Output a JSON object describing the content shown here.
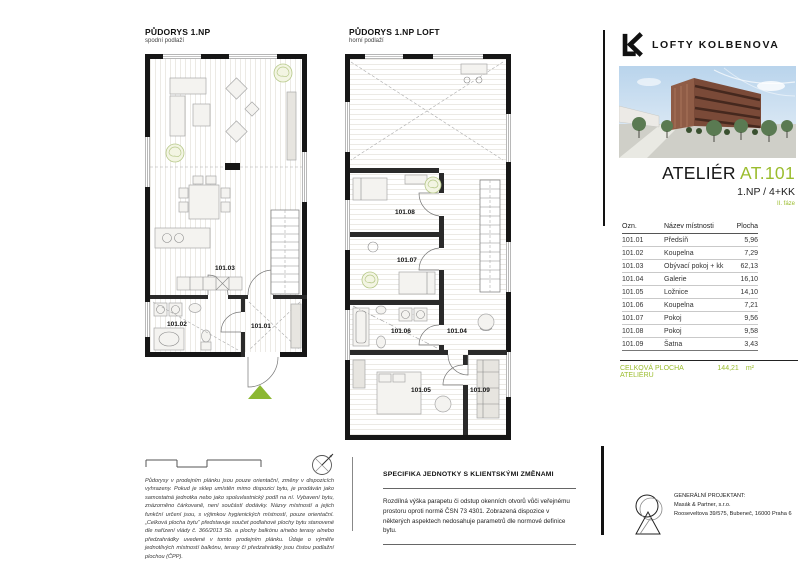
{
  "brand": {
    "logo": "LK",
    "name": "LOFTY KOLBENOVA"
  },
  "unit": {
    "type_label": "ATELIÉR",
    "id": "AT.101",
    "layout": "1.NP / 4+KK",
    "phase": "II. fáze"
  },
  "plans": {
    "lower": {
      "title": "PŮDORYS 1.NP",
      "subtitle": "spodní podlaží",
      "rooms": [
        "101.01",
        "101.02",
        "101.03"
      ]
    },
    "upper": {
      "title": "PŮDORYS 1.NP LOFT",
      "subtitle": "horní podlaží",
      "rooms": [
        "101.04",
        "101.05",
        "101.06",
        "101.07",
        "101.08",
        "101.09"
      ]
    }
  },
  "table": {
    "headers": {
      "code": "Ozn.",
      "name": "Název místnosti",
      "area": "Plocha"
    },
    "rows": [
      {
        "code": "101.01",
        "name": "Předsíň",
        "area": "5,96"
      },
      {
        "code": "101.02",
        "name": "Koupelna",
        "area": "7,29"
      },
      {
        "code": "101.03",
        "name": "Obývací pokoj + kk",
        "area": "62,13"
      },
      {
        "code": "101.04",
        "name": "Galerie",
        "area": "16,10"
      },
      {
        "code": "101.05",
        "name": "Ložnice",
        "area": "14,10"
      },
      {
        "code": "101.06",
        "name": "Koupelna",
        "area": "7,21"
      },
      {
        "code": "101.07",
        "name": "Pokoj",
        "area": "9,56"
      },
      {
        "code": "101.08",
        "name": "Pokoj",
        "area": "9,58"
      },
      {
        "code": "101.09",
        "name": "Šatna",
        "area": "3,43"
      }
    ],
    "total": {
      "label": "CELKOVÁ PLOCHA ATELIÉRU",
      "value": "144,21",
      "unit": "m²"
    }
  },
  "notes": {
    "disclaimer": "Půdorysy v prodejním plánku jsou pouze orientační, změny v dispozicích vyhrazeny. Pokud je sklep umístěn mimo dispozici bytu, je prodáván jako samostatná jednotka nebo jako spoluvlastnický podíl na ní. Vybavení bytu, znázorněno čárkovaně, není součástí dodávky. Názvy místností a jejich funkční určení jsou, s výjimkou hygienických místností, pouze orientační. „Celková plocha bytu“ představuje součet podlahové plochy bytu stanovené dle nařízení vlády č. 366/2013 Sb. a plochy balkónu a/nebo terasy a/nebo předzahrádky uvedené v tomto prodejním plánku. Údaje o výměře jednotlivých místností balkónu, terasy či předzahrádky jsou čistou podlažní plochou (ČPP).",
    "specifics_title": "SPECIFIKA JEDNOTKY S KLIENTSKÝMI ZMĚNAMI",
    "specifics_body": "Rozdílná výška parapetu či odstup okenních otvorů vůči veřejnému prostoru oproti normě ČSN 73 4301. Zobrazená dispozice v některých aspektech nedosahuje parametrů dle normové definice bytu."
  },
  "projectant": {
    "title": "GENERÁLNÍ PROJEKTANT:",
    "company": "Masák & Partner, s.r.o.",
    "address": "Rooseveltova 39/575, Bubeneč, 16000 Praha 6"
  },
  "colors": {
    "accent_green": "#9bbd2e",
    "triangle_green": "#8cb832",
    "wall_black": "#161616"
  }
}
